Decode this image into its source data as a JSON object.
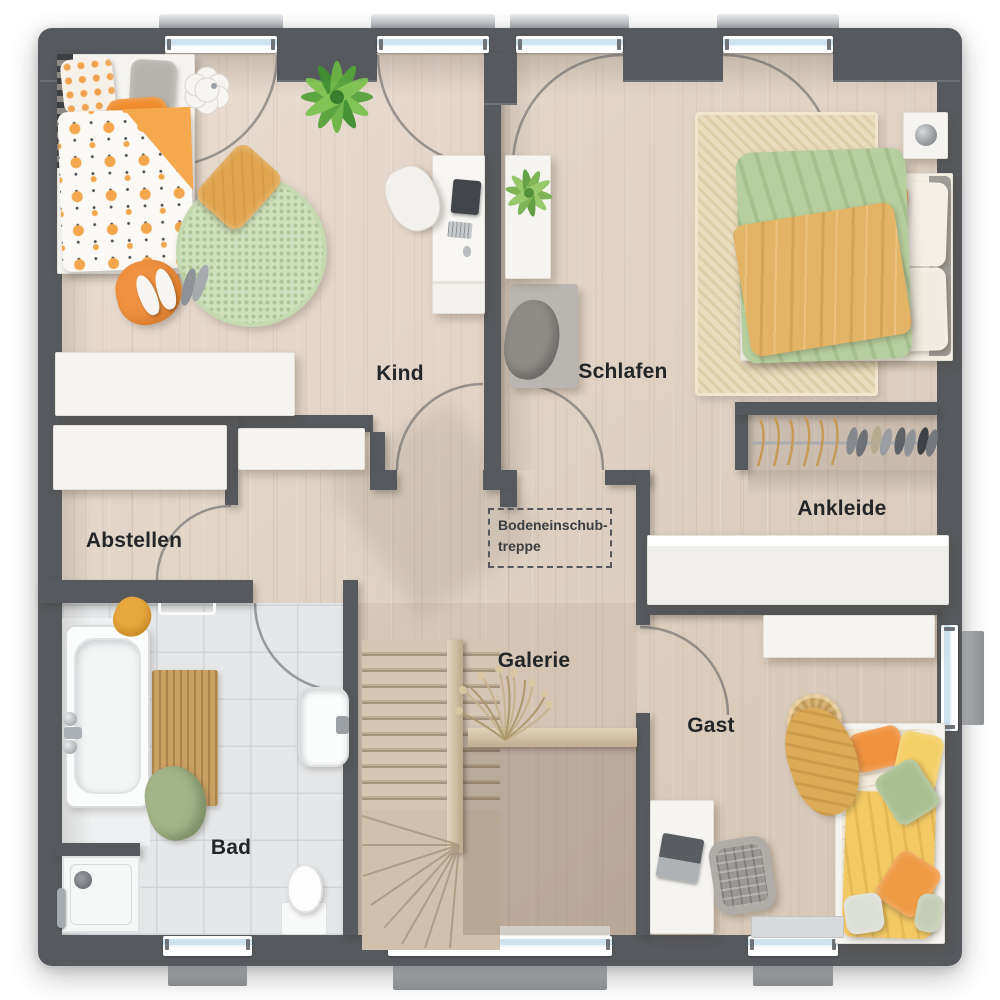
{
  "rooms": {
    "kind": {
      "label": "Kind"
    },
    "schlafen": {
      "label": "Schlafen"
    },
    "abstellen": {
      "label": "Abstellen"
    },
    "ankleide": {
      "label": "Ankleide"
    },
    "galerie": {
      "label": "Galerie"
    },
    "gast": {
      "label": "Gast"
    },
    "bad": {
      "label": "Bad"
    }
  },
  "annotations": {
    "loft_ladder": {
      "line1": "Bodeneinschub-",
      "line2": "treppe"
    }
  },
  "colors": {
    "wall": "#56595d",
    "floor_wood": "#d9cdc0",
    "tile": "#e4e6e8",
    "white_furniture": "#f5f4f1",
    "glass": "#cfe3ef",
    "accent_orange": "#f09a3e",
    "accent_green": "#b7cf9e",
    "accent_yellow": "#f3c964",
    "rug_green": "#cfe0bc",
    "rug_beige": "#e8ddbd",
    "stair_wood": "#cfc1ae"
  }
}
